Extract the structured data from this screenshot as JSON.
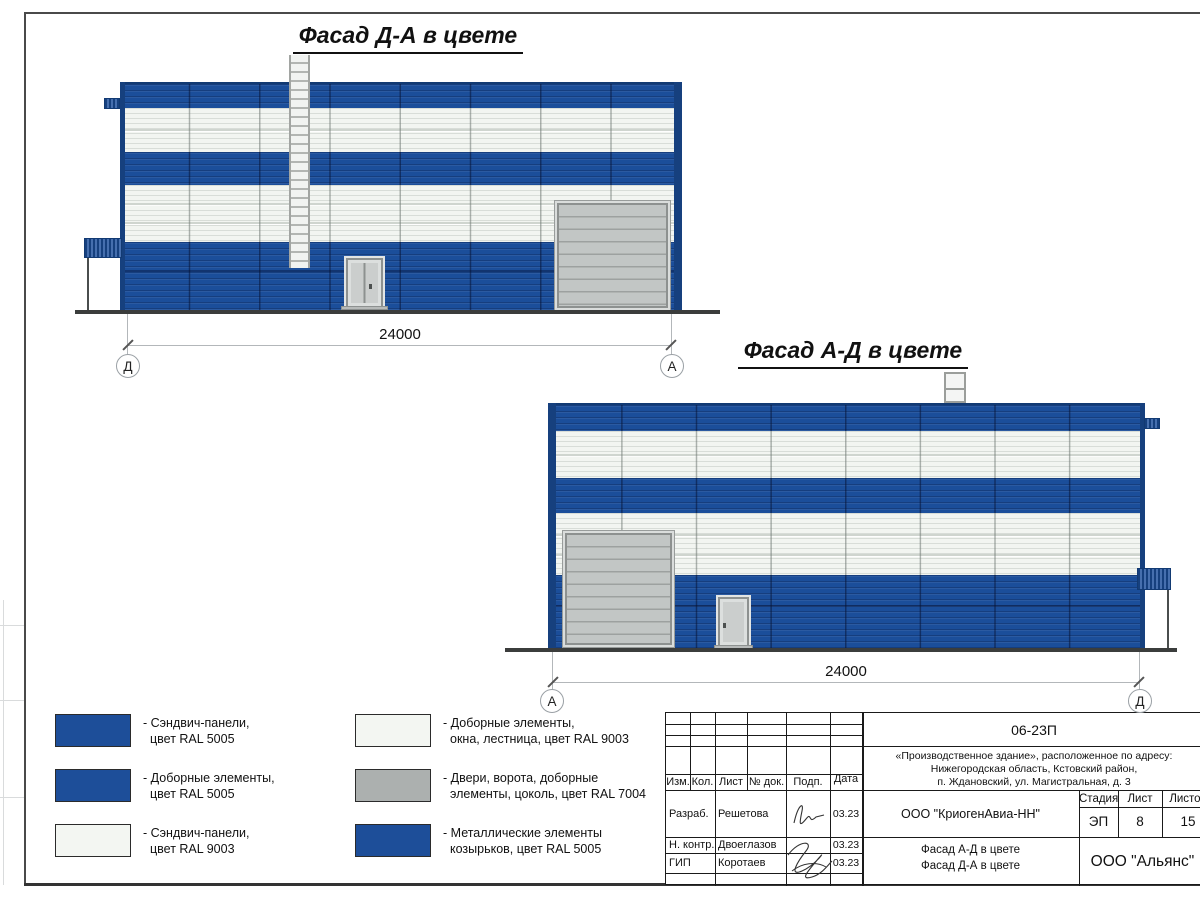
{
  "facades": {
    "da": {
      "title": "Фасад Д-А в цвете",
      "dimension": "24000",
      "axis_left": "Д",
      "axis_right": "А"
    },
    "ad": {
      "title": "Фасад А-Д в цвете",
      "dimension": "24000",
      "axis_left": "А",
      "axis_right": "Д"
    }
  },
  "legend": {
    "colors": {
      "blue": "#1d4e99",
      "white": "#f3f6f2",
      "gray": "#acb0af"
    },
    "items": [
      {
        "swatch": "blue",
        "line1": "- Сэндвич-панели,",
        "line2": "цвет RAL 5005"
      },
      {
        "swatch": "blue",
        "line1": "- Доборные элементы,",
        "line2": "цвет RAL 5005"
      },
      {
        "swatch": "white",
        "line1": "- Сэндвич-панели,",
        "line2": "цвет RAL 9003"
      },
      {
        "swatch": "white",
        "line1": "- Доборные элементы,",
        "line2": "окна, лестница, цвет RAL 9003"
      },
      {
        "swatch": "gray",
        "line1": "- Двери, ворота, доборные",
        "line2": "элементы, цоколь, цвет RAL 7004"
      },
      {
        "swatch": "blue",
        "line1": "- Металлические элементы",
        "line2": "козырьков, цвет RAL 5005"
      }
    ]
  },
  "titleblock": {
    "doc_number": "06-23П",
    "address_line1": "«Производственное здание», расположенное по адресу:",
    "address_line2": "Нижегородская область, Кстовский район,",
    "address_line3": "п. Ждановский, ул. Магистральная, д. 3",
    "columns": {
      "izm": "Изм.",
      "kol": "Кол.",
      "list": "Лист",
      "doc": "№ док.",
      "podp": "Подп.",
      "data": "Дата"
    },
    "rows": [
      {
        "role": "Разраб.",
        "name": "Решетова",
        "date": "03.23"
      },
      {
        "role": "Н. контр.",
        "name": "Двоеглазов",
        "date": "03.23"
      },
      {
        "role": "ГИП",
        "name": "Коротаев",
        "date": "03.23"
      }
    ],
    "org": "ООО \"КриогенАвиа-НН\"",
    "stage_label": "Стадия",
    "sheet_label": "Лист",
    "sheets_label": "Листов",
    "stage": "ЭП",
    "sheet": "8",
    "sheets": "15",
    "subject_line1": "Фасад А-Д в цвете",
    "subject_line2": "Фасад Д-А в цвете",
    "company": "ООО \"Альянс\""
  },
  "drawing_colors": {
    "facade_blue": "#1b4e9a",
    "panel_white": "#f2f5f1",
    "door_gray": "#c2c6c5",
    "ground": "#3b3d3c"
  }
}
